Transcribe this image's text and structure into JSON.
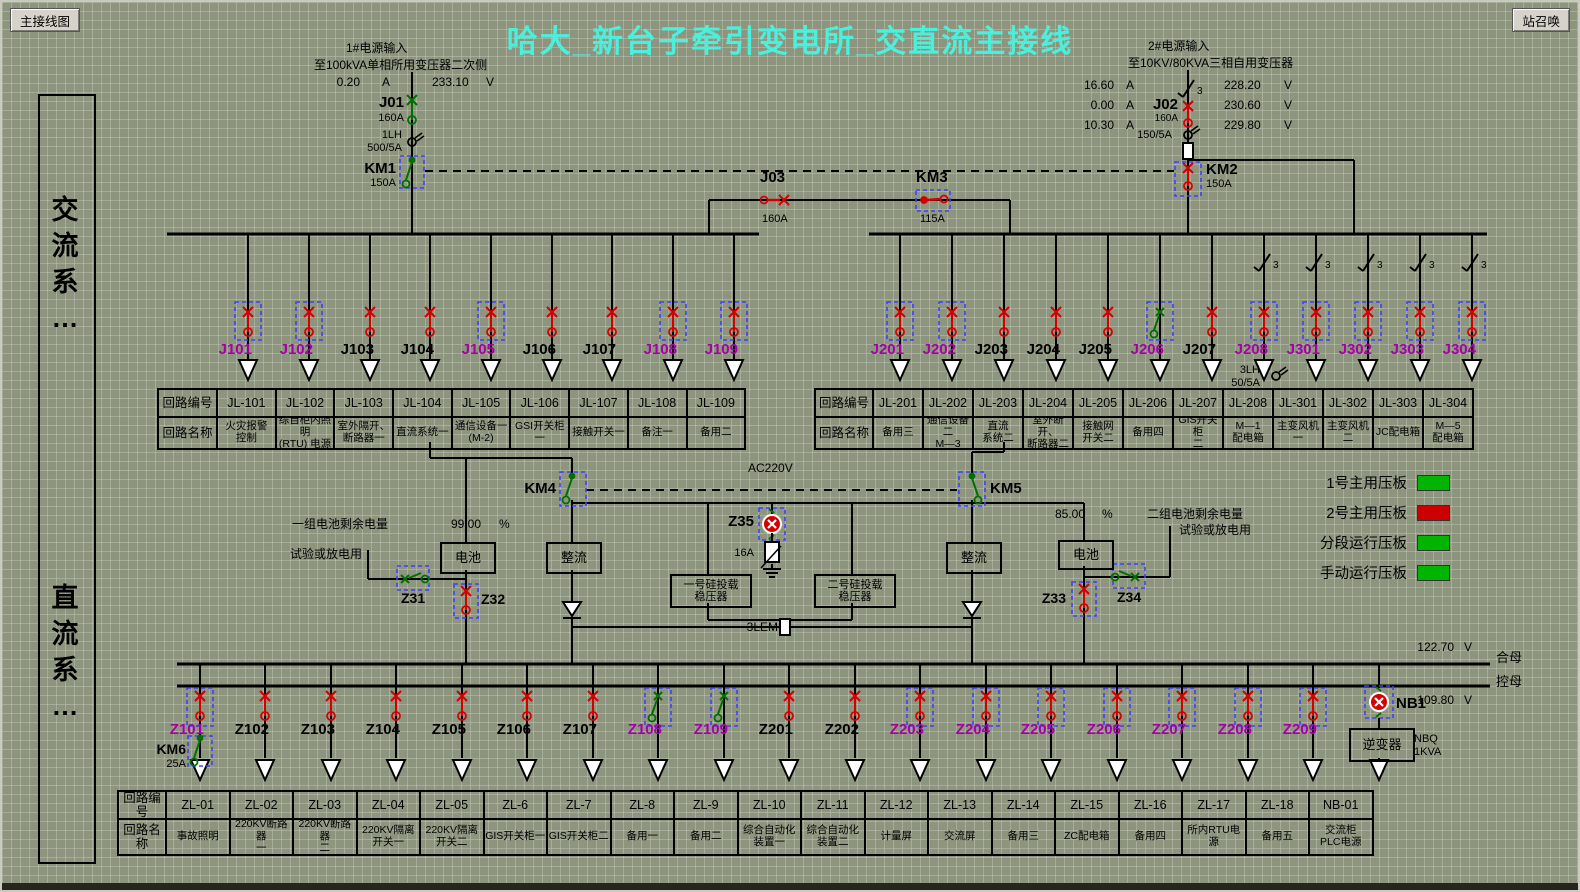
{
  "window": {
    "nav_button": "主接线图",
    "call_button": "站召唤",
    "title": "哈大_新台子牵引变电所_交直流主接线"
  },
  "sidebar": {
    "ac_label": "交\n流\n系\n…",
    "dc_label": "直\n流\n系\n…"
  },
  "source1": {
    "line1": "1#电源输入",
    "line2": "至100kVA单相所用变压器二次侧",
    "amp": "0.20",
    "amp_unit": "A",
    "volt": "233.10",
    "volt_unit": "V",
    "breaker": "J01",
    "breaker_rating": "160A",
    "ct": "1LH",
    "ct_ratio": "500/5A",
    "contactor": "KM1",
    "contactor_rating": "150A"
  },
  "source2": {
    "line1": "2#电源输入",
    "line2": "至10KV/80KVA三相自用变压器",
    "amps": [
      "16.60",
      "0.00",
      "10.30"
    ],
    "amp_unit": "A",
    "volts": [
      "228.20",
      "230.60",
      "229.80"
    ],
    "volt_unit": "V",
    "breaker": "J02",
    "breaker_rating": "160A",
    "ct_ratio": "150/5A",
    "contactor": "KM2",
    "contactor_rating": "150A",
    "phase_mark": "3"
  },
  "tie": {
    "j03": "J03",
    "j03_rating": "160A",
    "km3": "KM3",
    "km3_rating": "115A"
  },
  "ac_feeders_left": [
    {
      "id": "J101",
      "magenta": true,
      "boxed": true,
      "sym": "red"
    },
    {
      "id": "J102",
      "magenta": true,
      "boxed": true,
      "sym": "red"
    },
    {
      "id": "J103",
      "magenta": false,
      "boxed": false,
      "sym": "red"
    },
    {
      "id": "J104",
      "magenta": false,
      "boxed": false,
      "sym": "red"
    },
    {
      "id": "J105",
      "magenta": true,
      "boxed": true,
      "sym": "red"
    },
    {
      "id": "J106",
      "magenta": false,
      "boxed": false,
      "sym": "red"
    },
    {
      "id": "J107",
      "magenta": false,
      "boxed": false,
      "sym": "red"
    },
    {
      "id": "J108",
      "magenta": true,
      "boxed": true,
      "sym": "red"
    },
    {
      "id": "J109",
      "magenta": true,
      "boxed": true,
      "sym": "red"
    }
  ],
  "ac_feeders_right": [
    {
      "id": "J201",
      "magenta": true,
      "boxed": true,
      "sym": "red",
      "disc3": false
    },
    {
      "id": "J202",
      "magenta": true,
      "boxed": true,
      "sym": "red",
      "disc3": false
    },
    {
      "id": "J203",
      "magenta": false,
      "boxed": false,
      "sym": "red",
      "disc3": false
    },
    {
      "id": "J204",
      "magenta": false,
      "boxed": false,
      "sym": "red",
      "disc3": false
    },
    {
      "id": "J205",
      "magenta": false,
      "boxed": false,
      "sym": "red",
      "disc3": false
    },
    {
      "id": "J206",
      "magenta": true,
      "boxed": true,
      "sym": "green",
      "disc3": false
    },
    {
      "id": "J207",
      "magenta": false,
      "boxed": false,
      "sym": "red",
      "disc3": false
    },
    {
      "id": "J208",
      "magenta": true,
      "boxed": true,
      "sym": "red",
      "disc3": true
    },
    {
      "id": "J301",
      "magenta": true,
      "boxed": true,
      "sym": "red",
      "disc3": true
    },
    {
      "id": "J302",
      "magenta": true,
      "boxed": true,
      "sym": "red",
      "disc3": true
    },
    {
      "id": "J303",
      "magenta": true,
      "boxed": true,
      "sym": "red",
      "disc3": true
    },
    {
      "id": "J304",
      "magenta": true,
      "boxed": true,
      "sym": "red",
      "disc3": true
    }
  ],
  "j208_ct": {
    "name": "3LH",
    "ratio": "50/5A"
  },
  "ac_table_left": {
    "row1_label": "回路编号",
    "row2_label": "回路名称",
    "columns": [
      {
        "id": "JL-101",
        "name": "火灾报警\n控制"
      },
      {
        "id": "JL-102",
        "name": "综自柜内照明\n(RTU) 电源"
      },
      {
        "id": "JL-103",
        "name": "室外隔开、\n断路器一"
      },
      {
        "id": "JL-104",
        "name": "直流系统一"
      },
      {
        "id": "JL-105",
        "name": "通信设备一\n(M-2)"
      },
      {
        "id": "JL-106",
        "name": "GSI开关柜一"
      },
      {
        "id": "JL-107",
        "name": "接触开关一"
      },
      {
        "id": "JL-108",
        "name": "备注一"
      },
      {
        "id": "JL-109",
        "name": "备用二"
      }
    ]
  },
  "ac_table_right": {
    "row1_label": "回路编号",
    "row2_label": "回路名称",
    "columns": [
      {
        "id": "JL-201",
        "name": "备用三"
      },
      {
        "id": "JL-202",
        "name": "通信设备二\nM—3"
      },
      {
        "id": "JL-203",
        "name": "直流\n系统二"
      },
      {
        "id": "JL-204",
        "name": "室外断开、\n断路器二"
      },
      {
        "id": "JL-205",
        "name": "接触网\n开关二"
      },
      {
        "id": "JL-206",
        "name": "备用四"
      },
      {
        "id": "JL-207",
        "name": "GIS开关柜\n二"
      },
      {
        "id": "JL-208",
        "name": "M—1\n配电箱"
      },
      {
        "id": "JL-301",
        "name": "主变风机一"
      },
      {
        "id": "JL-302",
        "name": "主变风机二"
      },
      {
        "id": "JL-303",
        "name": "JC配电箱"
      },
      {
        "id": "JL-304",
        "name": "M—5\n配电箱"
      }
    ]
  },
  "mid": {
    "km4": "KM4",
    "km5": "KM5",
    "ac220v": "AC220V",
    "z35": "Z35",
    "z35_rating": "16A",
    "rectifier": "整流"
  },
  "battery1": {
    "gauge_label": "一组电池剩余电量",
    "gauge_value": "99.00",
    "gauge_unit": "%",
    "test_label": "试验或放电用",
    "sw_test": "Z31",
    "sw_main": "Z32",
    "box_label": "电池"
  },
  "battery2": {
    "gauge_label": "二组电池剩余电量",
    "gauge_value": "85.00",
    "gauge_unit": "%",
    "test_label": "试验或放电用",
    "sw_main": "Z33",
    "sw_test": "Z34",
    "box_label": "电池"
  },
  "stab": {
    "one": "一号硅投载\n稳压器",
    "two": "二号硅投载\n稳压器",
    "lem": "3LEM"
  },
  "legend": {
    "items": [
      {
        "label": "1号主用压板",
        "color": "#00b400"
      },
      {
        "label": "2号主用压板",
        "color": "#cc0000"
      },
      {
        "label": "分段运行压板",
        "color": "#00b400"
      },
      {
        "label": "手动运行压板",
        "color": "#00b400"
      }
    ]
  },
  "dc_bus": {
    "v_high": "122.70",
    "v_high_unit": "V",
    "bus_high": "合母",
    "v_low": "109.80",
    "v_low_unit": "V",
    "bus_low": "控母"
  },
  "km6": {
    "label": "KM6",
    "rating": "25A"
  },
  "nb1": {
    "label": "NB1",
    "inverter": "逆变器",
    "r1": "NBQ",
    "r2": "1KVA"
  },
  "dc_feeders": [
    {
      "id": "Z101",
      "magenta": true,
      "boxed": true,
      "sym": "red"
    },
    {
      "id": "Z102",
      "magenta": false,
      "boxed": false,
      "sym": "red"
    },
    {
      "id": "Z103",
      "magenta": false,
      "boxed": false,
      "sym": "red"
    },
    {
      "id": "Z104",
      "magenta": false,
      "boxed": false,
      "sym": "red"
    },
    {
      "id": "Z105",
      "magenta": false,
      "boxed": false,
      "sym": "red"
    },
    {
      "id": "Z106",
      "magenta": false,
      "boxed": false,
      "sym": "red"
    },
    {
      "id": "Z107",
      "magenta": false,
      "boxed": false,
      "sym": "red"
    },
    {
      "id": "Z108",
      "magenta": true,
      "boxed": true,
      "sym": "green"
    },
    {
      "id": "Z109",
      "magenta": true,
      "boxed": true,
      "sym": "green"
    },
    {
      "id": "Z201",
      "magenta": false,
      "boxed": false,
      "sym": "red"
    },
    {
      "id": "Z202",
      "magenta": false,
      "boxed": false,
      "sym": "red"
    },
    {
      "id": "Z203",
      "magenta": true,
      "boxed": true,
      "sym": "red"
    },
    {
      "id": "Z204",
      "magenta": true,
      "boxed": true,
      "sym": "red"
    },
    {
      "id": "Z205",
      "magenta": true,
      "boxed": true,
      "sym": "red"
    },
    {
      "id": "Z206",
      "magenta": true,
      "boxed": true,
      "sym": "red"
    },
    {
      "id": "Z207",
      "magenta": true,
      "boxed": true,
      "sym": "red"
    },
    {
      "id": "Z208",
      "magenta": true,
      "boxed": true,
      "sym": "red"
    },
    {
      "id": "Z209",
      "magenta": true,
      "boxed": true,
      "sym": "red"
    },
    {
      "id": "NB1",
      "magenta": false,
      "boxed": true,
      "sym": "alarm"
    }
  ],
  "dc_table": {
    "row1_label": "回路编号",
    "row2_label": "回路名称",
    "columns": [
      {
        "id": "ZL-01",
        "name": "事故照明"
      },
      {
        "id": "ZL-02",
        "name": "220KV断路器\n一"
      },
      {
        "id": "ZL-03",
        "name": "220KV断路器\n二"
      },
      {
        "id": "ZL-04",
        "name": "220KV隔离\n开关一"
      },
      {
        "id": "ZL-05",
        "name": "220KV隔离\n开关二"
      },
      {
        "id": "ZL-6",
        "name": "GIS开关柜一"
      },
      {
        "id": "ZL-7",
        "name": "GIS开关柜二"
      },
      {
        "id": "ZL-8",
        "name": "备用一"
      },
      {
        "id": "ZL-9",
        "name": "备用二"
      },
      {
        "id": "ZL-10",
        "name": "综合自动化\n装置一"
      },
      {
        "id": "ZL-11",
        "name": "综合自动化\n装置二"
      },
      {
        "id": "ZL-12",
        "name": "计量屏"
      },
      {
        "id": "ZL-13",
        "name": "交流屏"
      },
      {
        "id": "ZL-14",
        "name": "备用三"
      },
      {
        "id": "ZL-15",
        "name": "ZC配电箱"
      },
      {
        "id": "ZL-16",
        "name": "备用四"
      },
      {
        "id": "ZL-17",
        "name": "所内RTU电源"
      },
      {
        "id": "ZL-18",
        "name": "备用五"
      },
      {
        "id": "NB-01",
        "name": "交流柜\nPLC电源"
      }
    ]
  }
}
